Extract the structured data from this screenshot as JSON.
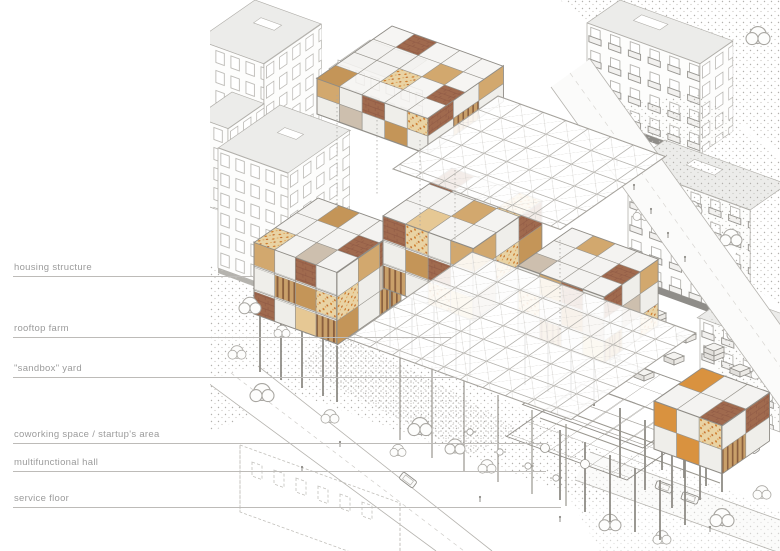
{
  "figure": {
    "type": "architectural-axonometric-diagram",
    "palette": {
      "label_text": "#9b9b9b",
      "leader_line": "#bdbbb8",
      "linework": "#a5a29c",
      "terracotta": "#a06a4e",
      "tan": "#d2a86e",
      "pale_tan": "#e6c894",
      "speckle_orange": "#d08030",
      "ground_stipple": "#b3b1ad"
    }
  },
  "labels": [
    {
      "text": "housing structure"
    },
    {
      "text": "rooftop farm"
    },
    {
      "text": "\"sandbox\" yard"
    },
    {
      "text": "coworking space / startup's area"
    },
    {
      "text": "multifunctional hall"
    },
    {
      "text": "service floor"
    }
  ]
}
